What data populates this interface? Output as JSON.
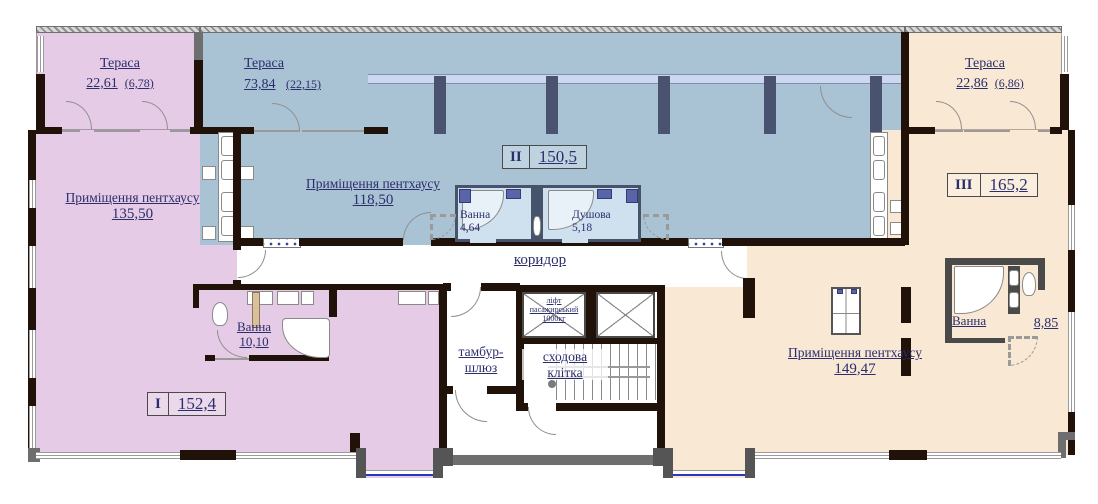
{
  "plan": {
    "units": [
      {
        "numeral": "I",
        "total_area": "152,4",
        "terrace": {
          "label": "Тераса",
          "area": "22,61",
          "open_area": "(6,78)"
        },
        "room": {
          "label": "Приміщення пентхаусу",
          "area": "135,50"
        },
        "bath": {
          "label": "Ванна",
          "area": "10,10"
        }
      },
      {
        "numeral": "II",
        "total_area": "150,5",
        "terrace": {
          "label": "Тераса",
          "area": "73,84",
          "open_area": "(22,15)"
        },
        "room": {
          "label": "Приміщення пентхаусу",
          "area": "118,50"
        },
        "bath": {
          "label": "Ванна",
          "area": "4,64"
        },
        "shower": {
          "label": "Душова",
          "area": "5,18"
        }
      },
      {
        "numeral": "III",
        "total_area": "165,2",
        "terrace": {
          "label": "Тераса",
          "area": "22,86",
          "open_area": "(6,86)"
        },
        "room": {
          "label": "Приміщення пентхаусу",
          "area": "149,47"
        },
        "bath": {
          "label": "Ванна",
          "area": "8,85"
        }
      }
    ],
    "core": {
      "corridor": "коридор",
      "vestibule_line1": "тамбур-",
      "vestibule_line2": "шлюз",
      "stairwell_line1": "сходова",
      "stairwell_line2": "клітка",
      "elevator_line1": "ліфт",
      "elevator_line2": "пасажирський",
      "elevator_line3": "1000кг"
    },
    "colors": {
      "unit1_fill": "#e5cbe5",
      "unit2_fill": "#a9c3d5",
      "unit3_fill": "#f8e8d4",
      "glass_band": "#ccd7f1",
      "wall": "#201208",
      "label_ink": "#2b2e6b",
      "window_line": "#2a35c0"
    }
  }
}
